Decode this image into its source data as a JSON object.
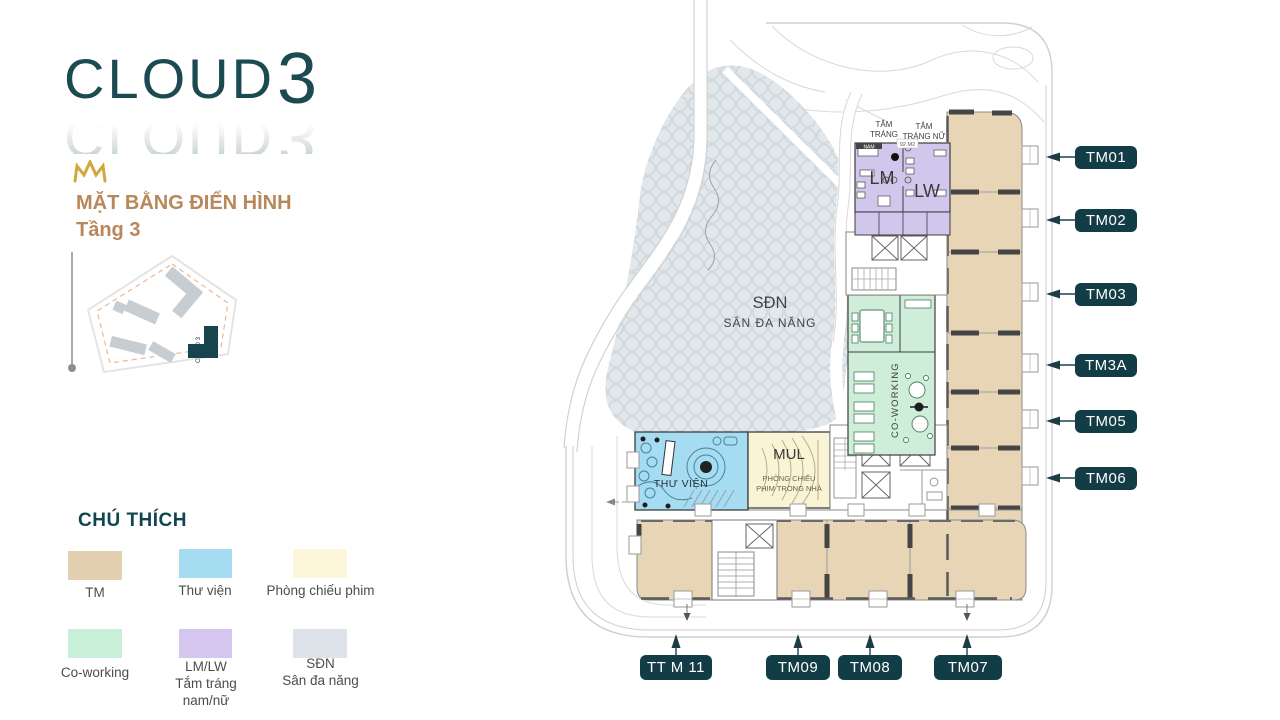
{
  "brand": {
    "logo_text": "CLOUD",
    "logo_number": "3",
    "logo_color": "#1b4a50",
    "crown_color": "#d2a83c"
  },
  "heading": {
    "line1": "MẶT BẰNG ĐIỂN HÌNH",
    "line2": "Tầng 3",
    "color": "#b8875a"
  },
  "mini_map": {
    "building_label": "CLOUD 3"
  },
  "legend": {
    "title": "CHÚ THÍCH",
    "items": [
      {
        "label": "TM",
        "color": "#e2d0b0"
      },
      {
        "label": "Thư viện",
        "color": "#a5dcf2"
      },
      {
        "label": "Phòng chiếu phim",
        "color": "#fdf6d8"
      },
      {
        "label": "Co-working",
        "color": "#c8efd7"
      },
      {
        "label": "LM/LW",
        "sub1": "Tắm tráng",
        "sub2": "nam/nữ",
        "color": "#d4c6ee"
      },
      {
        "label": "SĐN",
        "sub1": "Sân đa năng",
        "color": "#dde3e9"
      }
    ]
  },
  "plan": {
    "sdn": {
      "abbr": "SĐN",
      "name": "SÂN ĐA NĂNG"
    },
    "library": {
      "name": "THƯ VIỆN"
    },
    "cinema": {
      "code": "MUL",
      "name_line1": "PHÒNG CHIẾU",
      "name_line2": "PHIM TRONG NHÀ"
    },
    "coworking": {
      "name": "CO-WORKING"
    },
    "shower_male": {
      "code": "LM",
      "sign_line1": "TẮM",
      "sign_line2": "TRÁNG",
      "sign_line3": "NAM"
    },
    "shower_female": {
      "code": "LW",
      "sign_line1": "TẮM",
      "sign_line2": "TRÁNG NỮ"
    },
    "shower_area": "92 M2",
    "units_right": [
      "TM01",
      "TM02",
      "TM03",
      "TM3A",
      "TM05",
      "TM06"
    ],
    "units_bottom": [
      "TT M 11",
      "TM09",
      "TM08",
      "TM07"
    ]
  }
}
